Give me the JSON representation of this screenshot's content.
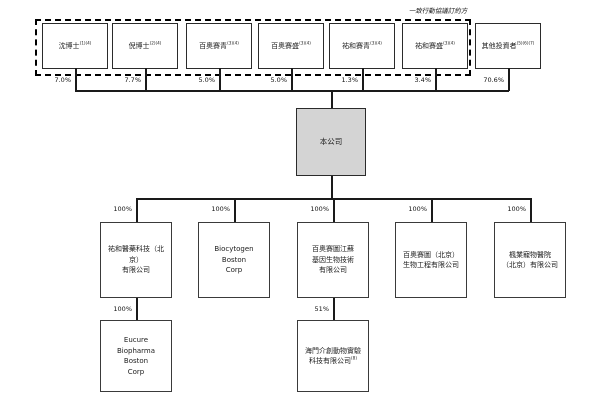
{
  "diagram": {
    "concert_label": "一致行動協議訂約方",
    "shareholders": [
      {
        "label": "沈博士",
        "note": "(1)(4)",
        "ownership": "7.0%"
      },
      {
        "label": "倪博士",
        "note": "(2)(4)",
        "ownership": "7.7%"
      },
      {
        "label": "百奧賽青",
        "note": "(3)(4)",
        "ownership": "5.0%"
      },
      {
        "label": "百奧賽盛",
        "note": "(3)(4)",
        "ownership": "5.0%"
      },
      {
        "label": "祐和賽青",
        "note": "(3)(4)",
        "ownership": "1.3%"
      },
      {
        "label": "祐和賽盛",
        "note": "(3)(4)",
        "ownership": "3.4%"
      },
      {
        "label": "其他投資者",
        "note": "(5)(6)(7)",
        "ownership": "70.6%"
      }
    ],
    "company": {
      "label": "本公司",
      "fill_color": "#d4d4d4"
    },
    "subsidiaries": [
      {
        "label": "祐和醫藥科技（北京）\n有限公司",
        "ownership": "100%"
      },
      {
        "label": "Biocytogen\nBoston\nCorp",
        "ownership": "100%"
      },
      {
        "label": "百奧賽圖江蘇\n基因生物技術\n有限公司",
        "ownership": "100%"
      },
      {
        "label": "百奧賽圖（北京）\n生物工程有限公司",
        "ownership": "100%"
      },
      {
        "label": "楓業寵物醫院\n（北京）有限公司",
        "ownership": "100%"
      }
    ],
    "sub_subsidiaries": [
      {
        "label": "Eucure\nBiopharma\nBoston\nCorp",
        "ownership": "100%"
      },
      {
        "label": "海門介創動物實驗\n科技有限公司",
        "note": "(8)",
        "ownership": "51%"
      }
    ]
  }
}
